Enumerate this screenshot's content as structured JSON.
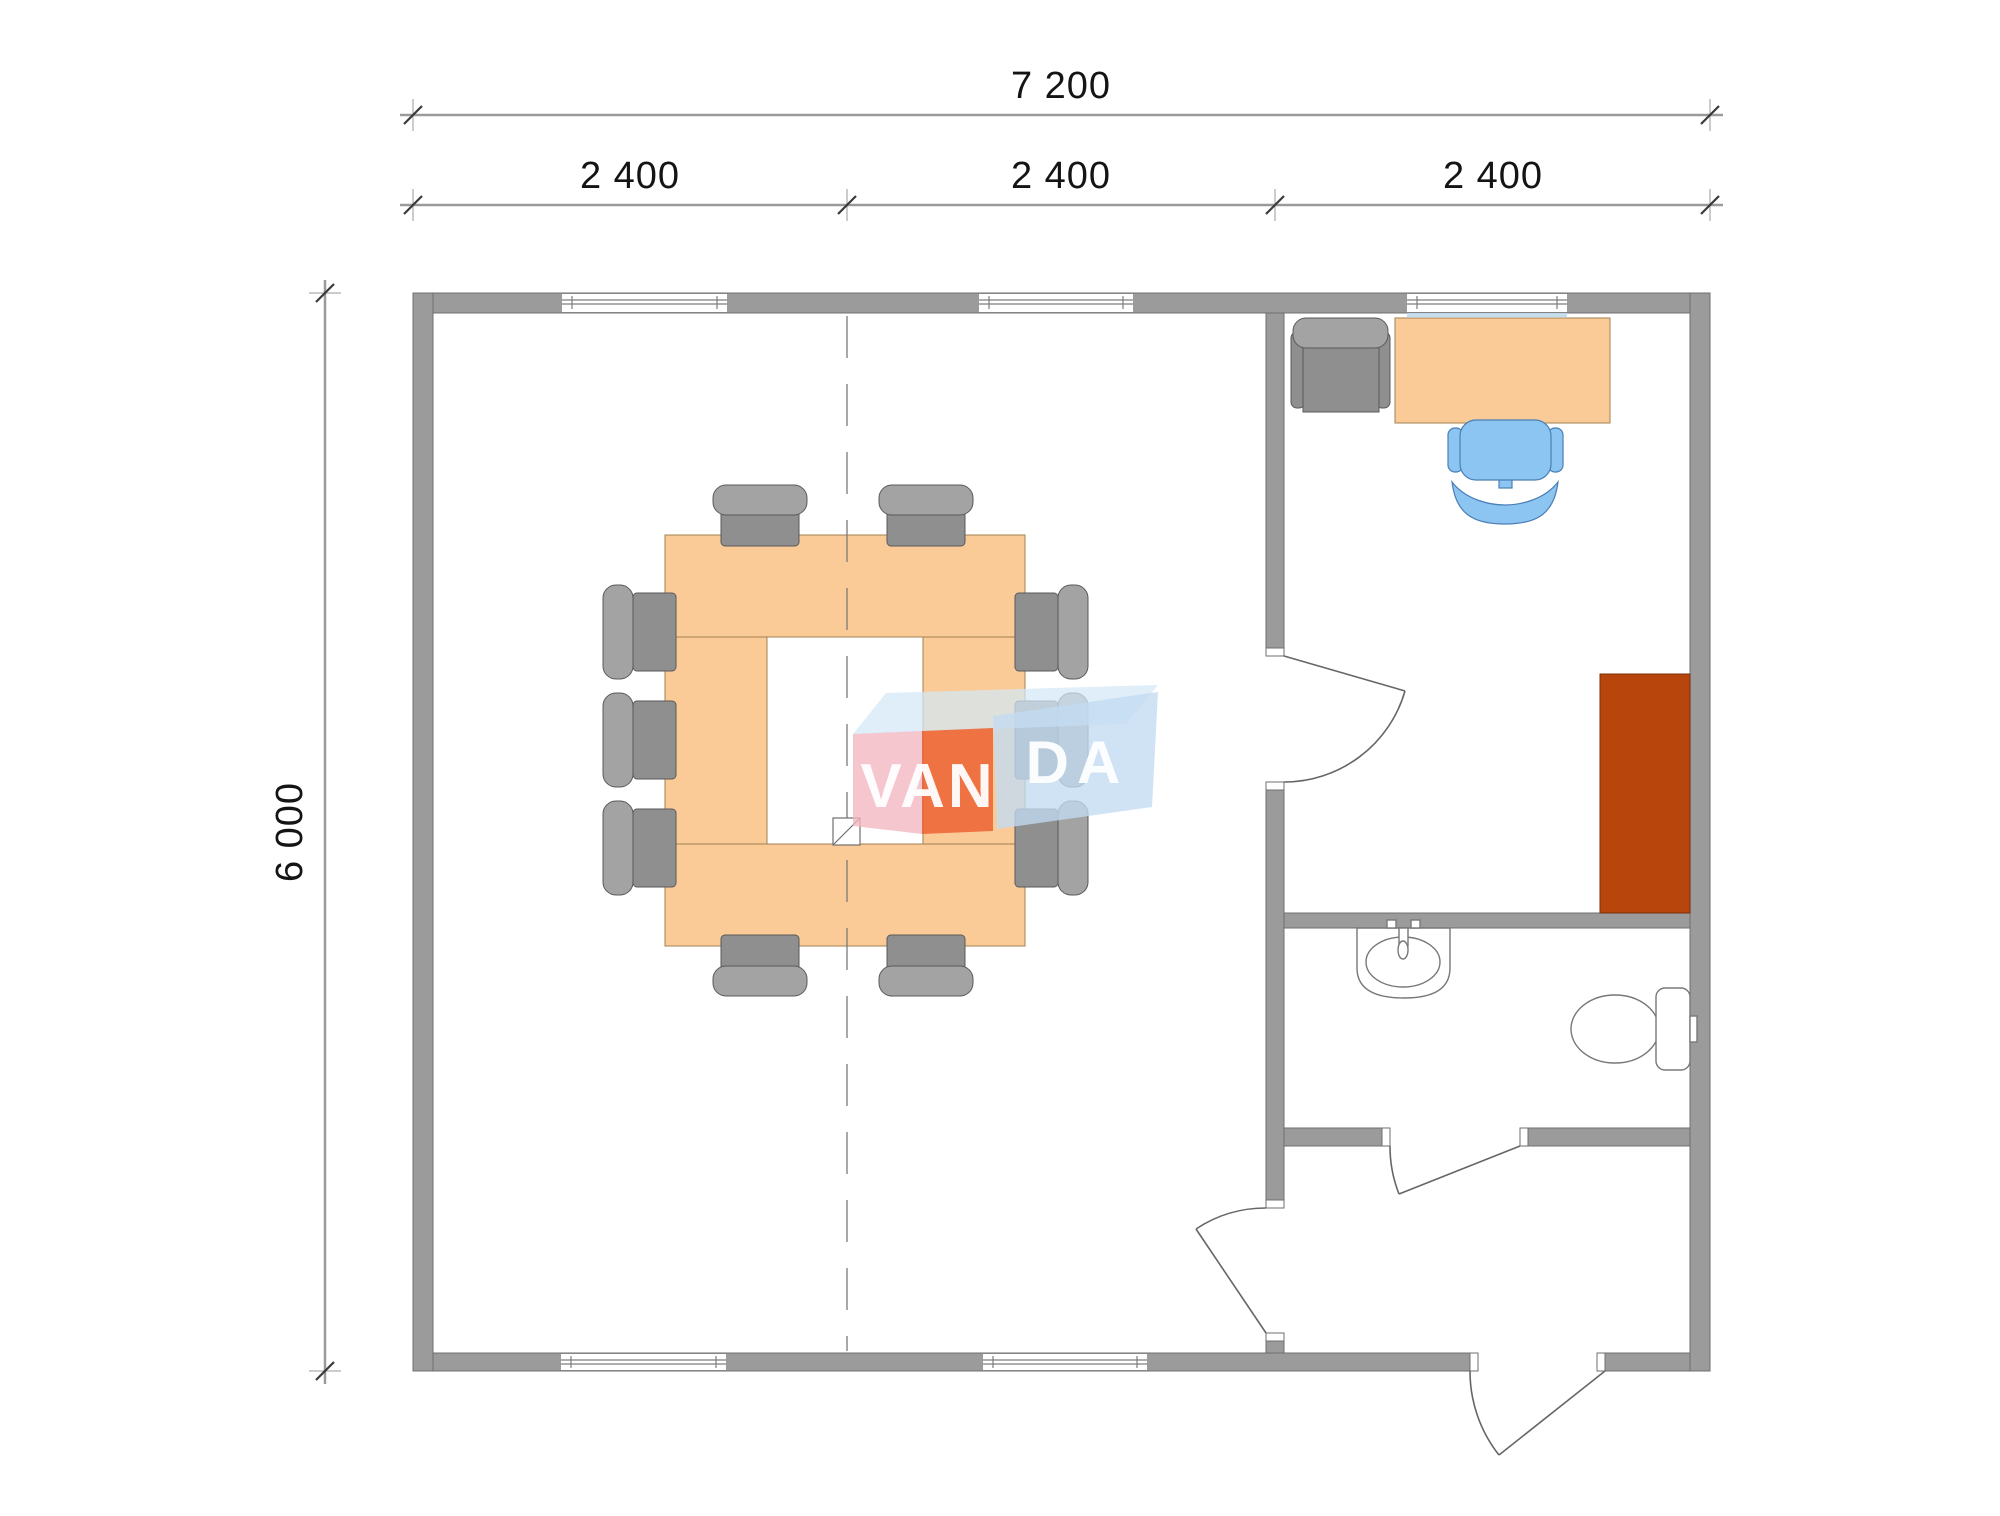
{
  "drawing": {
    "type": "architectural floor plan 7200x6000 with meeting room, office, bathroom and entrance hall",
    "dim_top_total": "7 200",
    "dim_top_segments": [
      "2 400",
      "2 400",
      "2 400"
    ],
    "dim_left_total": "6 000",
    "watermark": {
      "text_left": "VAN",
      "text_right": "DA"
    },
    "colors": {
      "wall_fill": "#9B9B9B",
      "wall_outline": "#6F6F6F",
      "wood_furniture": "#FBCB97",
      "gray_chair": "#8F8F8F",
      "office_chair_blue": "#8CC4F2",
      "cabinet_red_brown": "#B8450B",
      "watermark_pink": "#F4B6C2",
      "watermark_red": "#EB5B2D",
      "watermark_light_blue": "#C3DBF2"
    }
  }
}
